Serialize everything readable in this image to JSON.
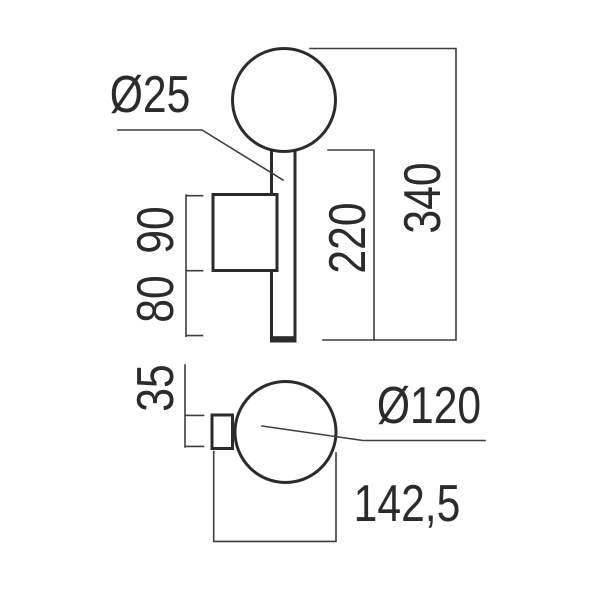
{
  "drawing": {
    "type": "technical-dimension-drawing",
    "subject": "wall lamp with spherical globe, stem and wall bracket — front elevation (top) and plan view (bottom)",
    "line_color": "#2b2b2b",
    "dim_color": "#3d3d3d",
    "background": "#ffffff",
    "dimensions": {
      "rod_diameter": "Ø25",
      "bracket_height": "90",
      "lower_drop": "80",
      "stem_length": "220",
      "total_height": "340",
      "mount_depth": "35",
      "sphere_diameter": "Ø120",
      "total_projection": "142,5"
    }
  }
}
